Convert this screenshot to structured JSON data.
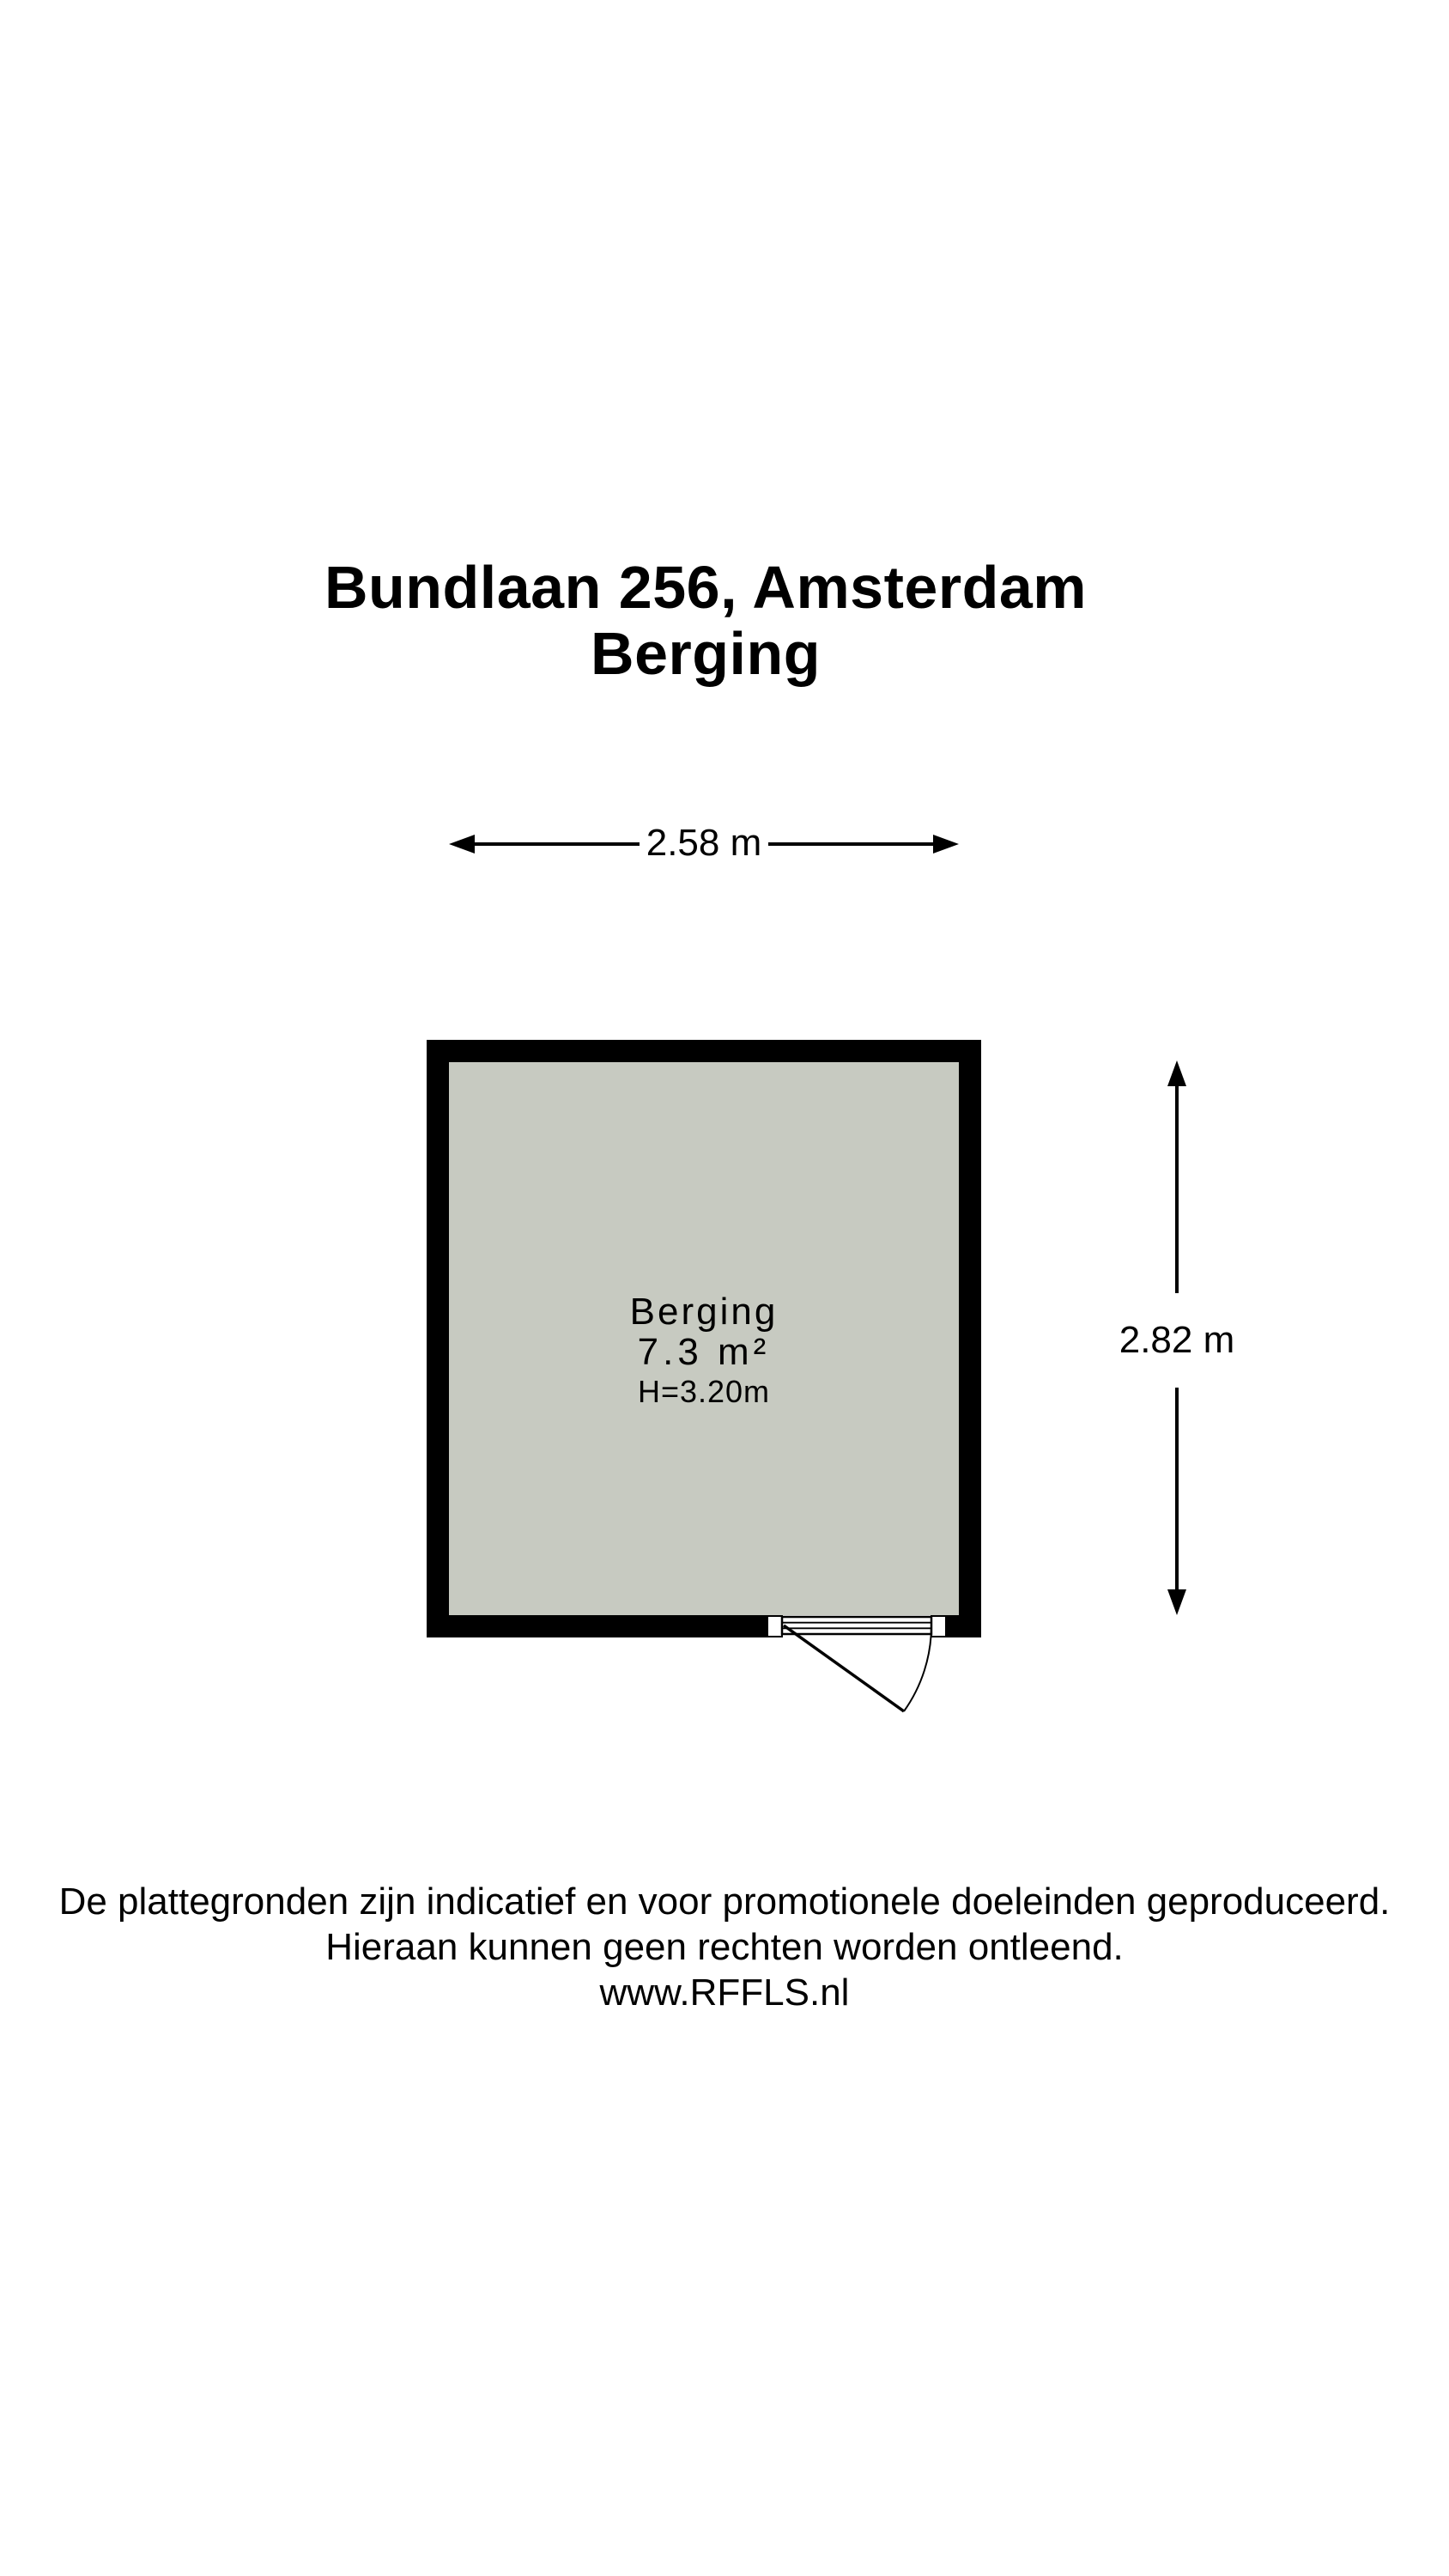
{
  "title": {
    "address": "Bundlaan 256, Amsterdam",
    "subtitle": "Berging"
  },
  "dimensions": {
    "width": "2.58 m",
    "height": "2.82 m"
  },
  "room": {
    "name": "Berging",
    "area": "7.3 m²",
    "ceiling_height": "H=3.20m"
  },
  "footer": {
    "line1": "De plattegronden zijn indicatief en voor promotionele doeleinden geproduceerd.",
    "line2": "Hieraan kunnen geen rechten worden ontleend.",
    "website": "www.RFFLS.nl"
  },
  "colors": {
    "wall": "#000000",
    "floor": "#c7cac1",
    "text": "#000000",
    "background": "#ffffff"
  }
}
